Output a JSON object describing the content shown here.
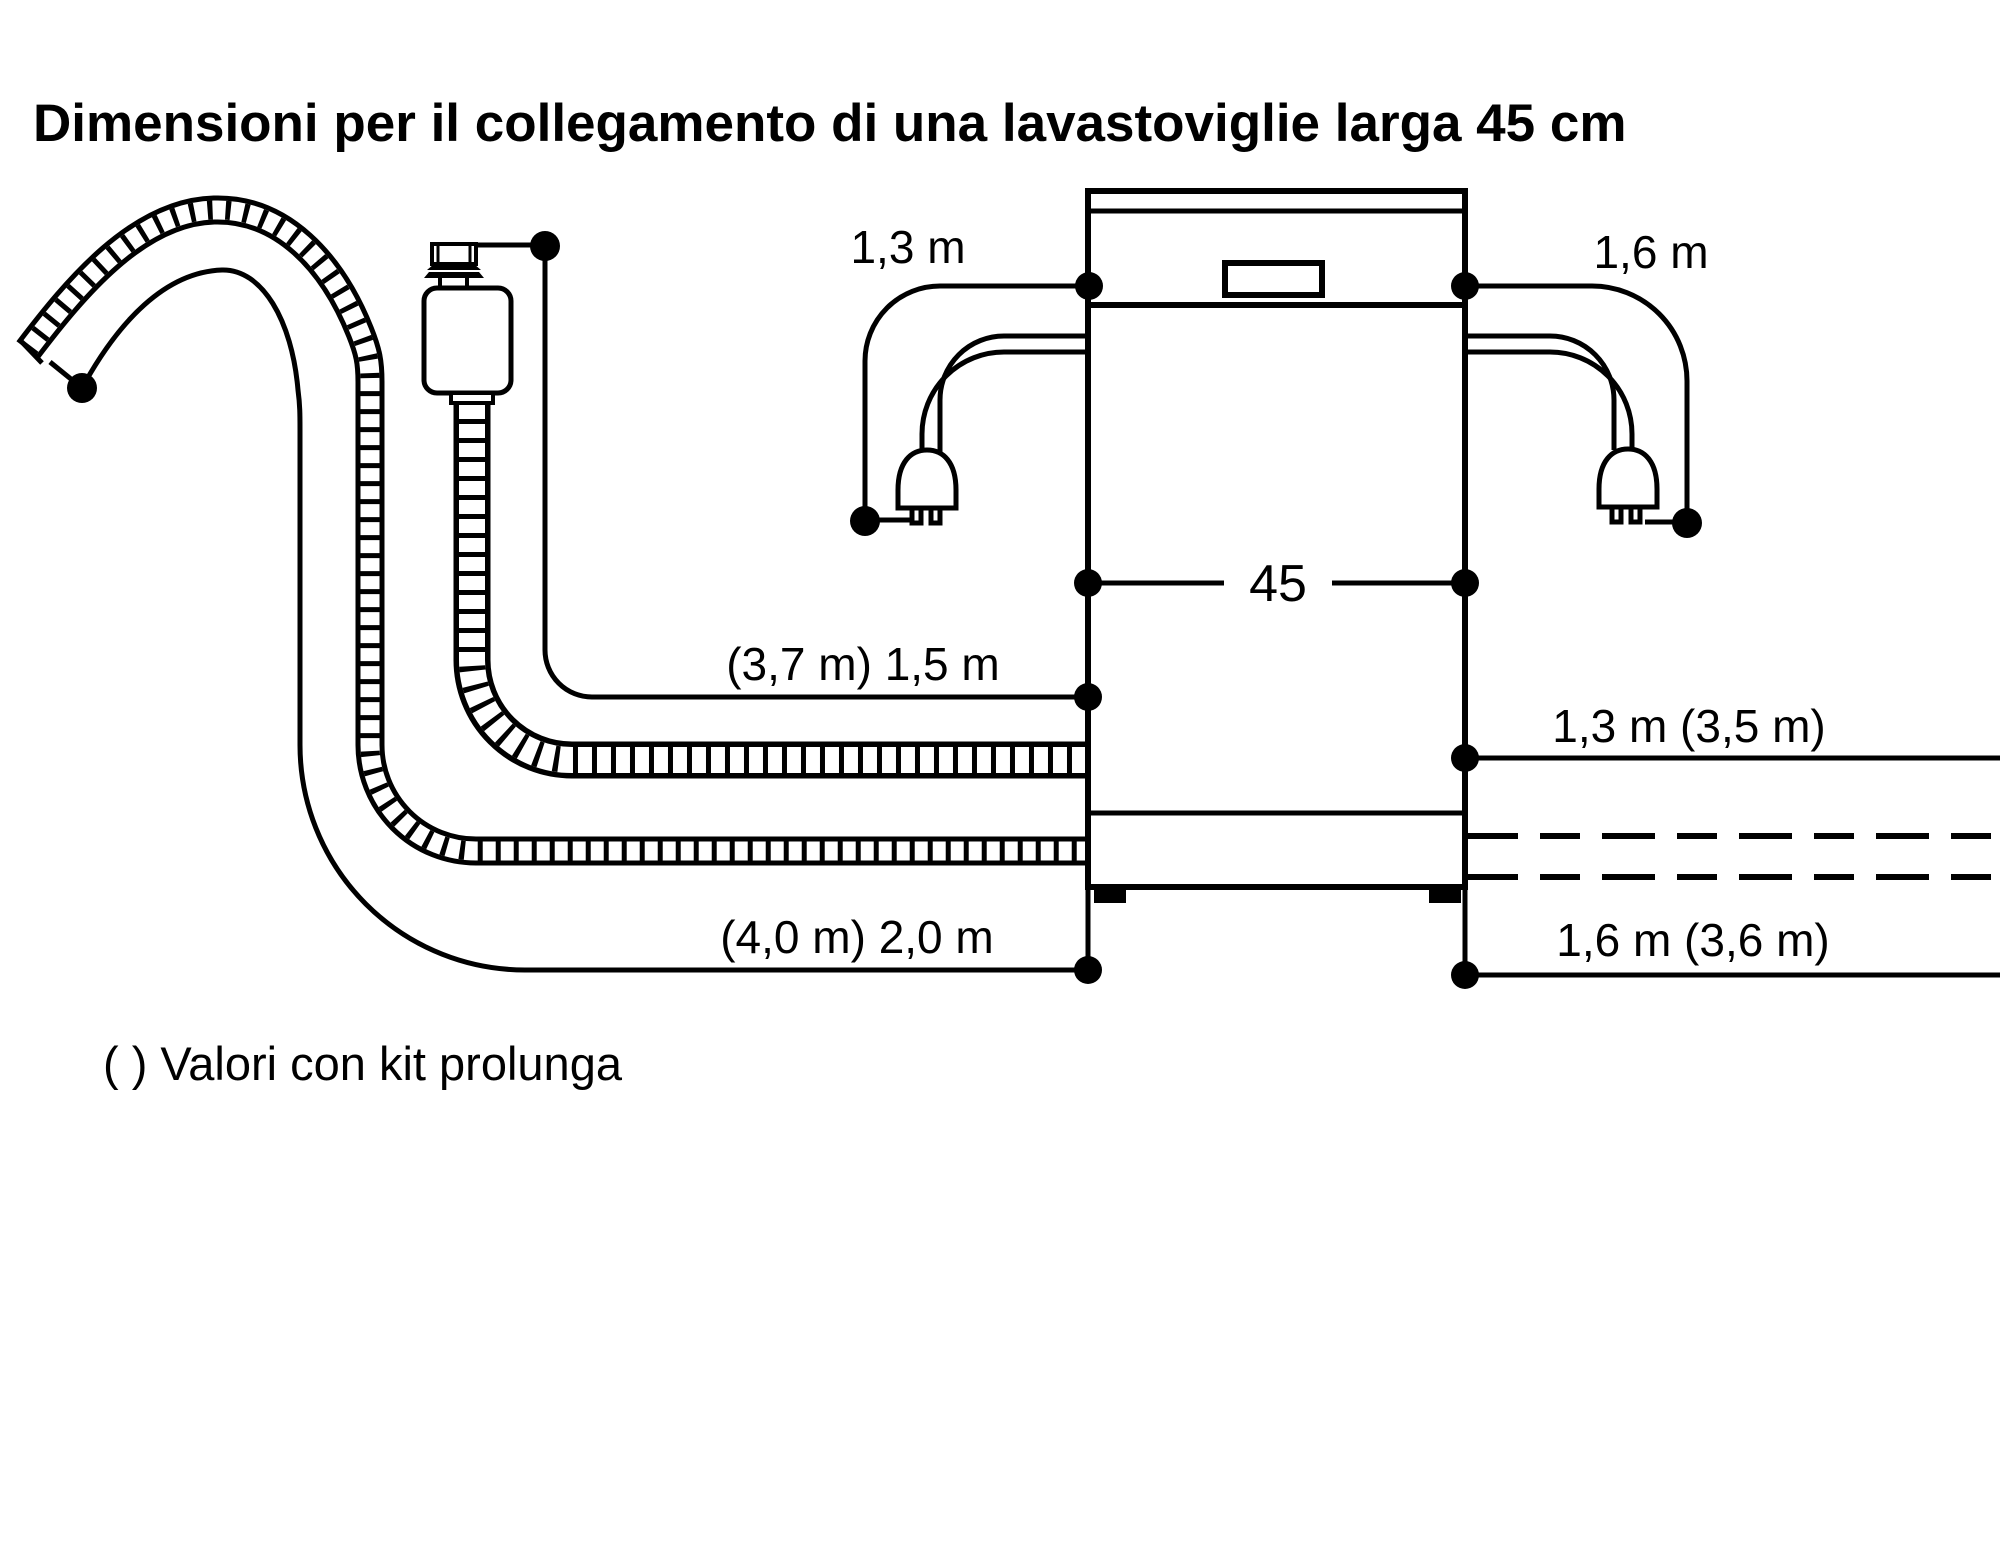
{
  "title": "Dimensioni per il collegamento di una lavastoviglie larga 45 cm",
  "footnote": "( ) Valori con kit prolunga",
  "labels": {
    "appliance_width": "45",
    "power_cord_left": "1,3 m",
    "power_cord_right": "1,6 m",
    "inlet_hose_left": "(3,7 m) 1,5 m",
    "inlet_hose_right": "1,3 m (3,5 m)",
    "drain_hose_left": "(4,0 m) 2,0 m",
    "drain_hose_right": "1,6 m (3,6 m)"
  },
  "colors": {
    "foreground": "#000000",
    "background": "#ffffff"
  }
}
